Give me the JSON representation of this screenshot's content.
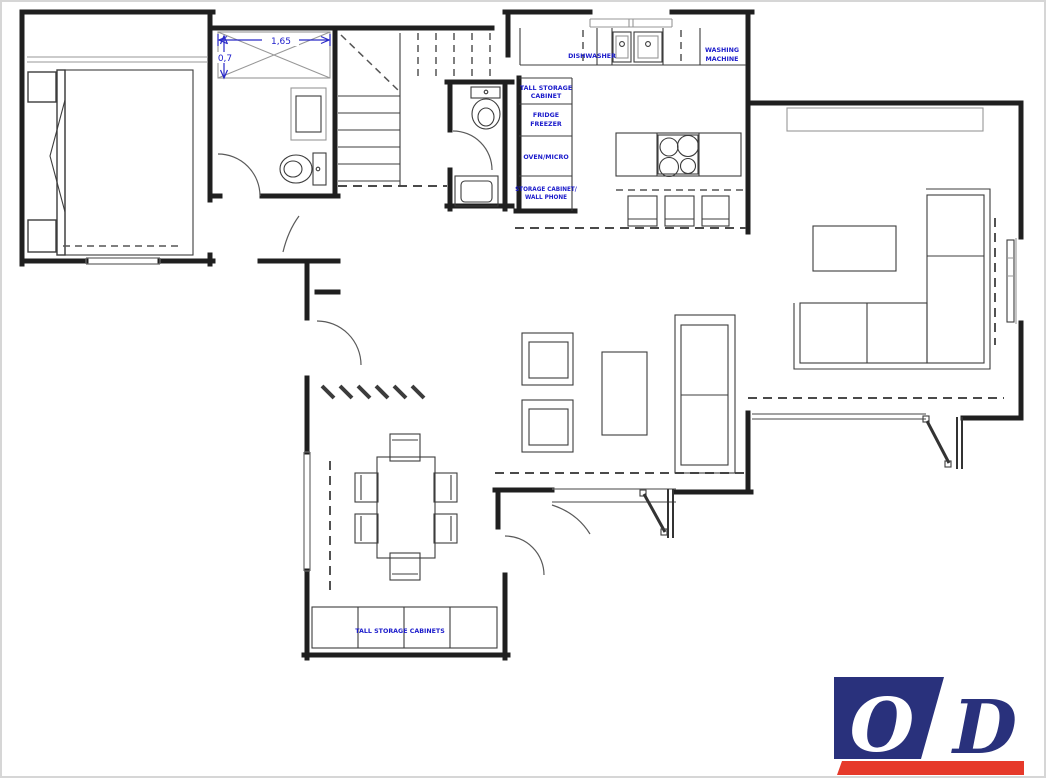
{
  "document": {
    "type": "ground-floor-plan"
  },
  "colors": {
    "wall": "#1f1f1f",
    "annotation_blue": "#1b1bcb",
    "dimension_blue": "#2a2ac8",
    "logo_navy": "#29317c",
    "logo_red": "#e6392a",
    "logo_white": "#ffffff"
  },
  "dimensions": {
    "wardrobe_width": "1,65",
    "wardrobe_depth": "0,7"
  },
  "labels": {
    "dishwasher": "DISHWASHER",
    "washing_machine_line1": "WASHING",
    "washing_machine_line2": "MACHINE",
    "tall_storage_line1": "TALL STORAGE",
    "tall_storage_line2": "CABINET",
    "fridge_line1": "FRIDGE",
    "fridge_line2": "FREEZER",
    "oven_micro": "OVEN/MICRO",
    "storage_cabinet_line1": "STORAGE CABINET/",
    "storage_cabinet_line2": "WALL PHONE",
    "dining_cabinets": "TALL STORAGE CABINETS"
  },
  "logo": {
    "letter_left": "O",
    "letter_right": "D"
  }
}
